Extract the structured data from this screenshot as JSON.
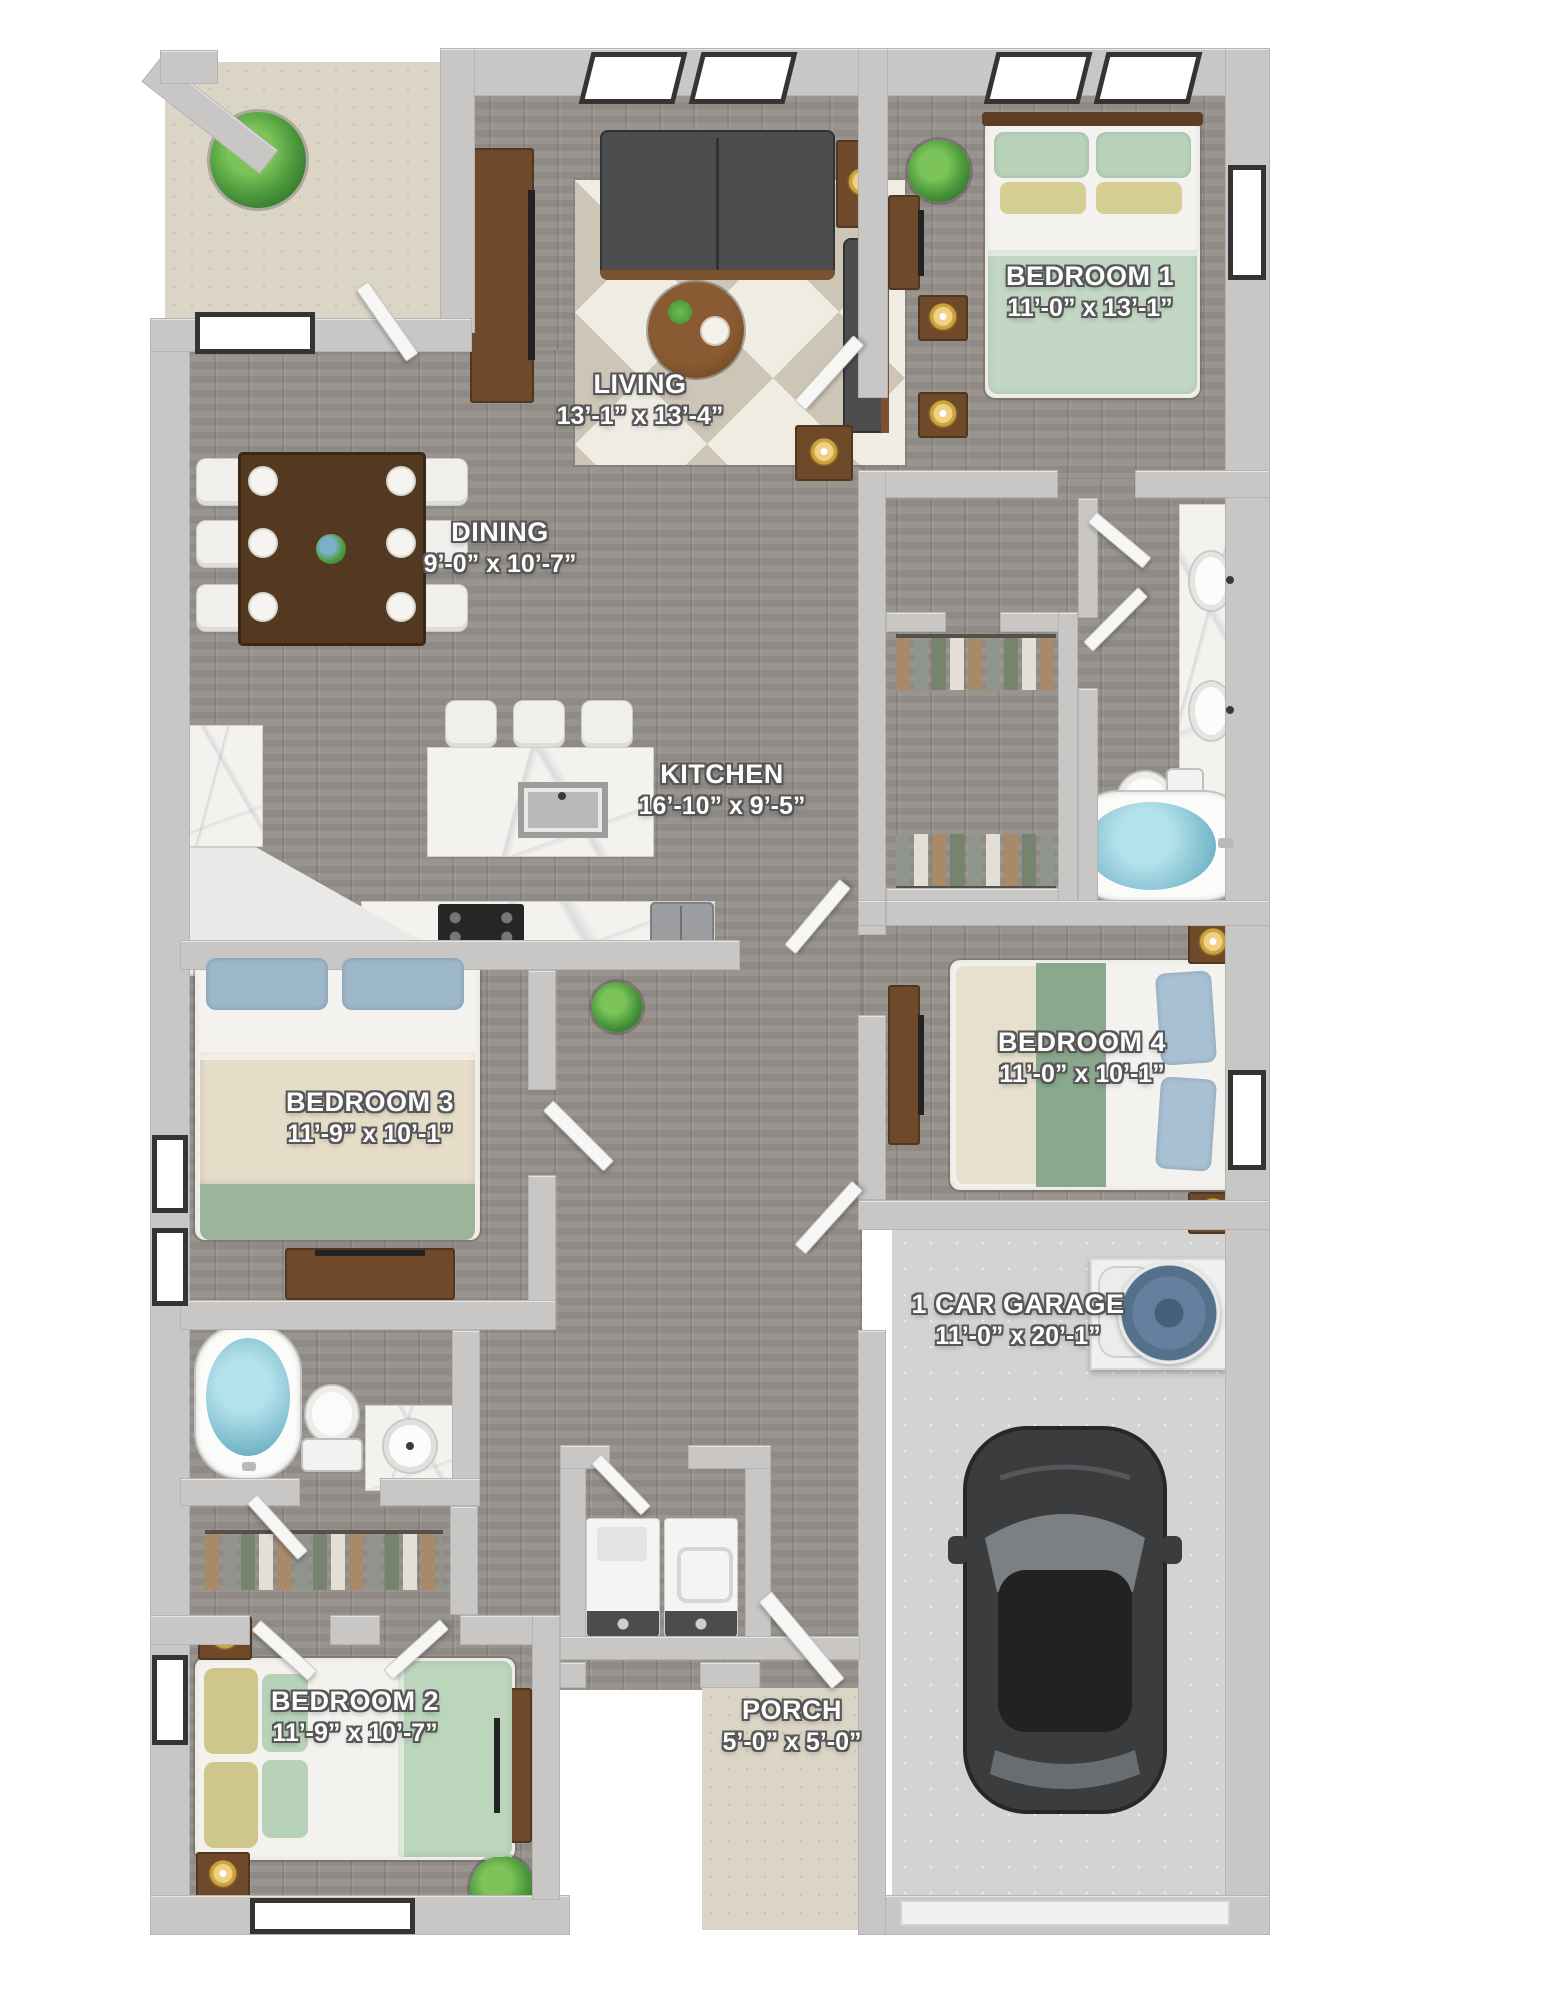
{
  "rooms": {
    "living": {
      "name": "LIVING",
      "dims": "13’-1” x 13’-4”"
    },
    "bedroom1": {
      "name": "BEDROOM 1",
      "dims": "11’-0” x 13’-1”"
    },
    "dining": {
      "name": "DINING",
      "dims": "9’-0” x 10’-7”"
    },
    "kitchen": {
      "name": "KITCHEN",
      "dims": "16’-10” x 9’-5”"
    },
    "bedroom3": {
      "name": "BEDROOM 3",
      "dims": "11’-9” x 10’-1”"
    },
    "bedroom4": {
      "name": "BEDROOM 4",
      "dims": "11’-0” x 10’-1”"
    },
    "garage": {
      "name": "1 CAR GARAGE",
      "dims": "11’-0” x 20’-1”"
    },
    "bedroom2": {
      "name": "BEDROOM 2",
      "dims": "11’-9” x 10’-7”"
    },
    "porch": {
      "name": "PORCH",
      "dims": "5’-0” x 5’-0”"
    }
  },
  "palette": {
    "wood_floor": "#95908a",
    "patio_tile": "#dbd5c6",
    "garage_concrete": "#d3d3d1",
    "wall_gray": "#c8c7c5",
    "label_text": "#fdfdfd",
    "label_outline": "#565656",
    "bedding_green": "#bcd6bd",
    "bedding_sage": "#8aa88d",
    "pillow_blue": "#a4bdd1",
    "pillow_yellow": "#d3cb8e",
    "furniture_brown": "#6e4a2b",
    "sofa_gray": "#4b4d4f",
    "tub_water_blue": "#8ec7d6",
    "car_gray": "#3b3c3e",
    "water_heater_blue": "#64809e",
    "plant_green": "#4e9b3e",
    "marble_white": "#f3f2ef"
  }
}
